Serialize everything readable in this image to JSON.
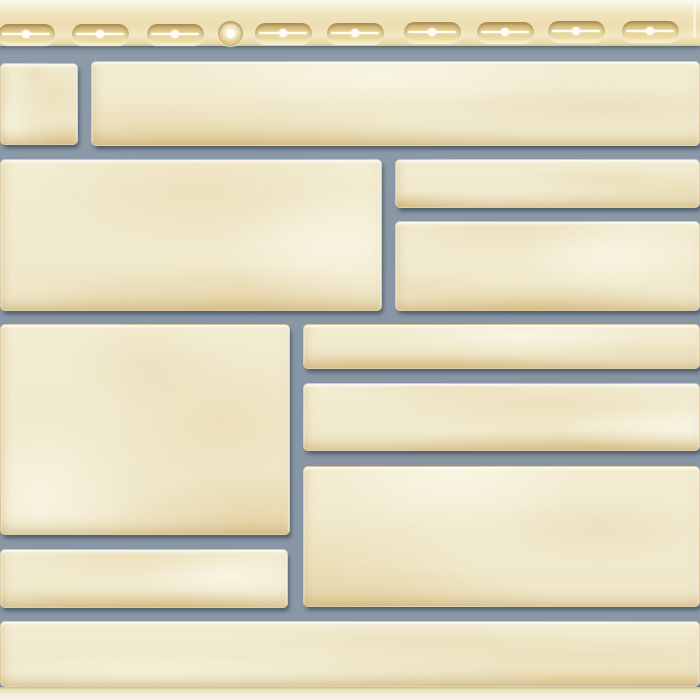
{
  "panel": {
    "subject": "vinyl-facade-siding-panel-imitating-cut-stone-masonry",
    "width": 700,
    "height": 700,
    "colors": {
      "strip_base": "#f0e4bd",
      "strip_top_highlight": "#fbfaf3",
      "strip_bottom_line": "#d8c28c",
      "slot_rim": "#c1a467",
      "slot_fill": "#ead89f",
      "slot_slit": "#fffdf0",
      "mortar": "#8795a4",
      "mortar_shadow": "#76848f",
      "stone_face": "#f2ecd2",
      "stone_mottle": "#e6d9ae",
      "stone_chip_edge": "#d8ba80",
      "bottom_strip": "#f2edda",
      "bottom_line": "#c9c083"
    },
    "nail_strip": {
      "height": 46,
      "slot_width": 57,
      "slot_height": 21,
      "slots": [
        {
          "cx": 26,
          "cy": 34
        },
        {
          "cx": 100,
          "cy": 34
        },
        {
          "cx": 175,
          "cy": 34
        },
        {
          "cx": 283,
          "cy": 33
        },
        {
          "cx": 355,
          "cy": 33
        },
        {
          "cx": 432,
          "cy": 32
        },
        {
          "cx": 505,
          "cy": 32
        },
        {
          "cx": 576,
          "cy": 31
        },
        {
          "cx": 650,
          "cy": 31
        }
      ],
      "round_hole": {
        "cx": 230,
        "cy": 33,
        "d": 25
      }
    },
    "stones": [
      {
        "x": 0,
        "y": 63,
        "w": 78,
        "h": 82
      },
      {
        "x": 91,
        "y": 61,
        "w": 609,
        "h": 85
      },
      {
        "x": 0,
        "y": 159,
        "w": 382,
        "h": 152
      },
      {
        "x": 395,
        "y": 159,
        "w": 305,
        "h": 49
      },
      {
        "x": 395,
        "y": 221,
        "w": 305,
        "h": 90
      },
      {
        "x": 0,
        "y": 324,
        "w": 290,
        "h": 211
      },
      {
        "x": 303,
        "y": 324,
        "w": 397,
        "h": 45
      },
      {
        "x": 303,
        "y": 383,
        "w": 397,
        "h": 68
      },
      {
        "x": 303,
        "y": 466,
        "w": 397,
        "h": 141
      },
      {
        "x": 0,
        "y": 549,
        "w": 288,
        "h": 59
      },
      {
        "x": 0,
        "y": 621,
        "w": 700,
        "h": 66
      }
    ],
    "bottom_edge": {
      "y": 687,
      "height": 13
    }
  }
}
